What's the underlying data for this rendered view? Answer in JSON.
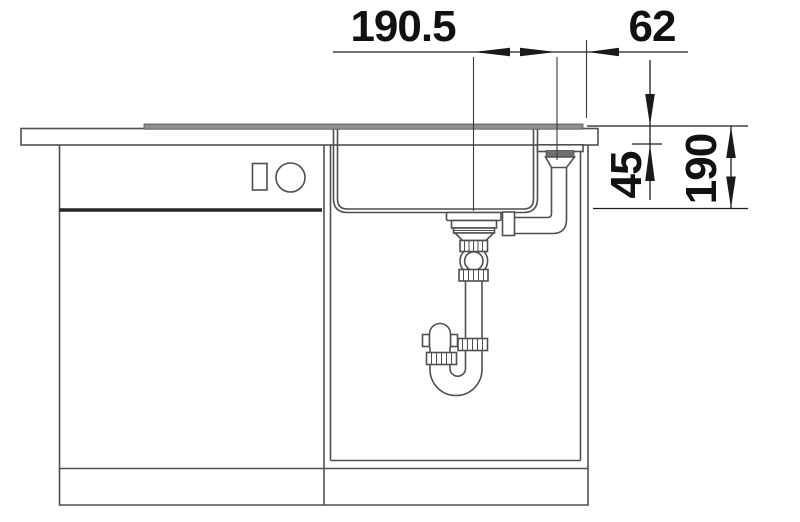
{
  "figure": {
    "type": "technical-installation-drawing",
    "subject": "sink-cabinet-cross-section-with-drain-plumbing"
  },
  "dimensions": {
    "top_left": "190.5",
    "top_right": "62",
    "right_inner": "45",
    "right_outer": "190"
  },
  "colors": {
    "structure_line": "#4f4f4f",
    "dimension_line": "#1c1c1c",
    "dimension_text": "#111111",
    "sink_rim_fill": "#8f8f8f",
    "overflow_flange_fill": "#707070",
    "background": "#ffffff"
  }
}
